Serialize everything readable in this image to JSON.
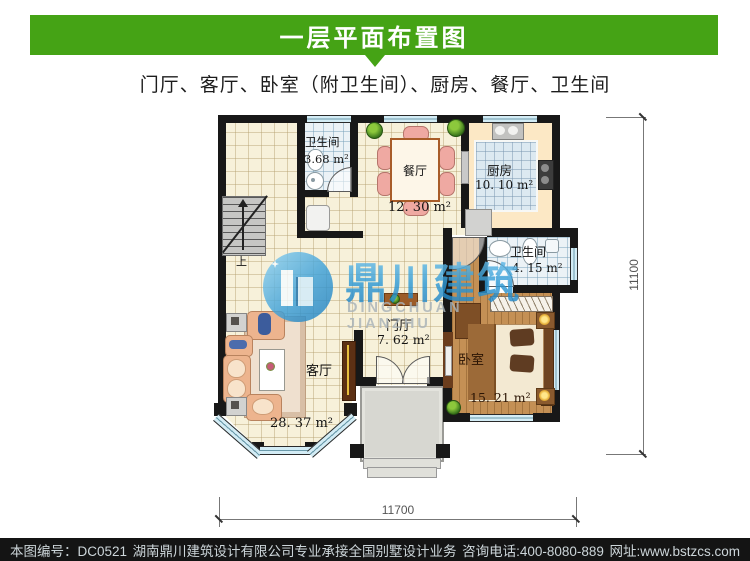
{
  "header": {
    "title": "一层平面布置图",
    "subtitle": "门厅、客厅、卧室（附卫生间）、厨房、餐厅、卫生间",
    "accent_color": "#45a315"
  },
  "plan": {
    "rooms": [
      {
        "id": "bathroom-1",
        "name": "卫生间",
        "area": "3.68 m²"
      },
      {
        "id": "dining",
        "name": "餐厅",
        "area": "12. 30 m²"
      },
      {
        "id": "kitchen",
        "name": "厨房",
        "area": "10. 10 m²"
      },
      {
        "id": "bathroom-2",
        "name": "卫生间",
        "area": "4. 15 m²"
      },
      {
        "id": "foyer",
        "name": "门厅",
        "area": "7. 62 m²"
      },
      {
        "id": "living",
        "name": "客厅",
        "area": "28. 37 m²"
      },
      {
        "id": "bedroom",
        "name": "卧室",
        "area": "15. 21 m²"
      }
    ],
    "stairs_label": "上",
    "dimensions": {
      "width_mm": "11700",
      "height_mm": "11100"
    },
    "wall_color": "#181818"
  },
  "watermark": {
    "name_zh": "鼎川建筑",
    "name_en": "DINGCHUAN JIANZHU",
    "brand_color": "#2f9ad6"
  },
  "footer": {
    "sheet_no": "本图编号：DC0521",
    "company": "湖南鼎川建筑设计有限公司专业承接全国别墅设计业务",
    "phone": "咨询电话:400-8080-889",
    "website": "网址:www.bstzcs.com"
  }
}
